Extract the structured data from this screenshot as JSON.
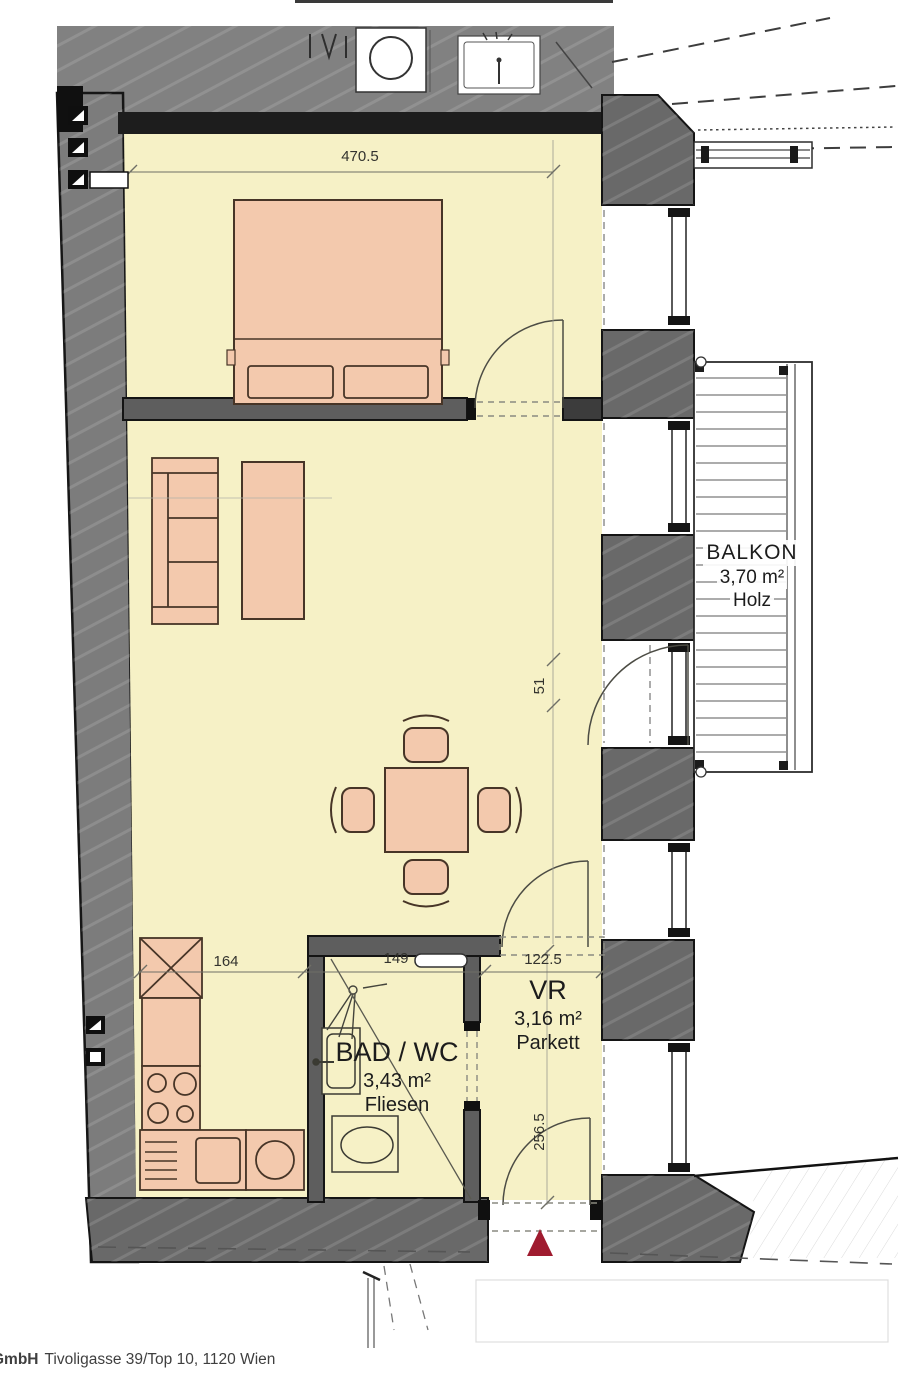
{
  "rooms": {
    "bad_wc": {
      "name": "BAD / WC",
      "area": "3,43 m²",
      "floor": "Fliesen"
    },
    "vr": {
      "name": "VR",
      "area": "3,16 m²",
      "floor": "Parkett"
    },
    "balkon": {
      "name": "BALKON",
      "area": "3,70 m²",
      "floor": "Holz"
    }
  },
  "dimensions": {
    "bedroom_width": "470.5",
    "kitchen_segment": "164",
    "bath_segment": "149",
    "vr_segment": "122.5",
    "door_offset": "51",
    "vr_depth": "256.5"
  },
  "footer": {
    "company": "GmbH",
    "address": "Tivoligasse 39/Top 10, 1120 Wien"
  },
  "colors": {
    "floor": "#f6f1c6",
    "furniture": "#f3c9ad",
    "wall_gray": "#6a6a6a",
    "wall_black": "#1d1d1d",
    "entrance_marker": "#9f1b2f"
  }
}
